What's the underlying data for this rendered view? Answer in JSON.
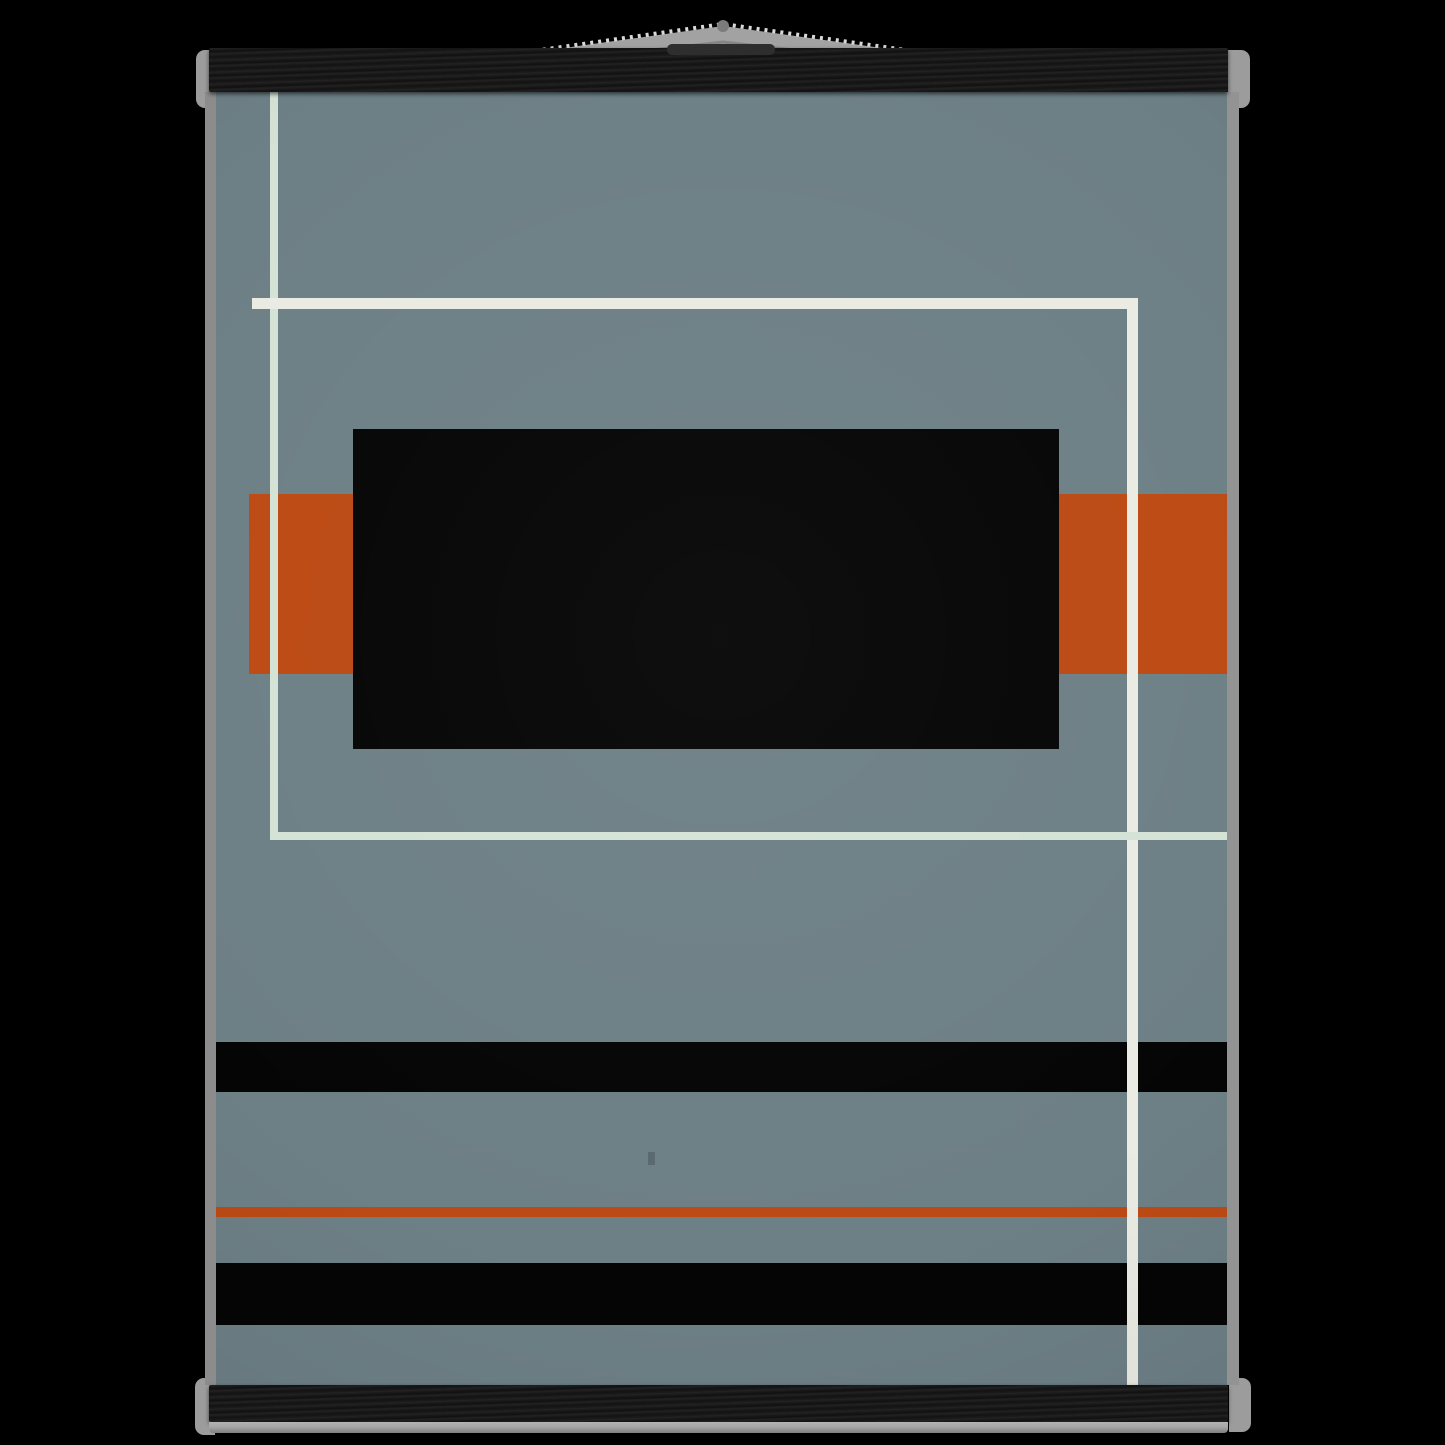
{
  "scene": {
    "type": "poster-mockup-photo",
    "description": "Abstract geometric minimalist art print in slate blue-gray with a large central black rectangle, rust-orange blocks, black horizontal stripes, a thin orange rule and off-white/mint grid lines; the print hangs from black wooden magnetic poster hangers with a gray cord on a black background",
    "background_color": "#000000"
  },
  "colors": {
    "scene-bg": "#000000",
    "poster-bg": "#6d8086",
    "art-black": "#050505",
    "art-orange": "#bc4a14",
    "art-mint": "#d4e3d6",
    "art-cream": "#eaebe2",
    "wood": "#191919",
    "cap": "#9c9c9c",
    "strip-left": "#8c8c8c",
    "strip-right": "#939393",
    "lip": "#a6a6a6",
    "string-fill": "#a2a2a2",
    "string-hi": "#d8d8d8",
    "string-sh": "#858585",
    "nail-dot": "#7b7b7b",
    "slit": "#2e2e2e",
    "speck": "#44525a"
  },
  "hanger": {
    "top_bar": {
      "x": 209,
      "y": 48,
      "w": 1019,
      "h": 44
    },
    "bottom_bar": {
      "x": 209,
      "y": 1385,
      "w": 1019,
      "h": 37
    },
    "bottom_lip": {
      "x": 209,
      "y": 1422,
      "w": 1019,
      "h": 11
    },
    "caps": [
      {
        "name": "hanger-cap-top-left",
        "side": "left",
        "x": 196,
        "y": 50,
        "w": 20,
        "h": 58
      },
      {
        "name": "hanger-cap-top-right",
        "side": "right",
        "x": 1228,
        "y": 50,
        "w": 22,
        "h": 58
      },
      {
        "name": "hanger-cap-bottom-left",
        "side": "left",
        "x": 195,
        "y": 1378,
        "w": 20,
        "h": 57
      },
      {
        "name": "hanger-cap-bottom-right",
        "side": "right",
        "x": 1229,
        "y": 1378,
        "w": 22,
        "h": 54
      }
    ],
    "string": {
      "apex": [
        723,
        26
      ],
      "left_end": [
        218,
        96
      ],
      "right_end": [
        1228,
        96
      ],
      "nail_dot": {
        "cx": 723,
        "cy": 26,
        "r": 6
      },
      "slit": {
        "x": 667,
        "y": 44,
        "w": 108,
        "h": 11
      }
    }
  },
  "poster": {
    "x": 216,
    "y": 92,
    "w": 1011,
    "h": 1293,
    "left_edge_strip": {
      "x": 205,
      "y": 92,
      "w": 11,
      "h": 1293
    },
    "right_edge_strip": {
      "x": 1227,
      "y": 92,
      "w": 12,
      "h": 1293
    }
  },
  "artwork": {
    "elements": [
      {
        "name": "orange-block-left",
        "x": 249,
        "y": 494,
        "w": 104,
        "h": 180,
        "color": "art-orange"
      },
      {
        "name": "orange-block-right",
        "x": 1059,
        "y": 494,
        "w": 168,
        "h": 180,
        "color": "art-orange"
      },
      {
        "name": "center-black-rectangle",
        "x": 353,
        "y": 429,
        "w": 706,
        "h": 320,
        "color": "art-black"
      },
      {
        "name": "black-stripe-upper",
        "x": 216,
        "y": 1042,
        "w": 1011,
        "h": 50,
        "color": "art-black"
      },
      {
        "name": "orange-rule-line",
        "x": 216,
        "y": 1207,
        "w": 1011,
        "h": 10,
        "color": "art-orange"
      },
      {
        "name": "black-stripe-lower",
        "x": 216,
        "y": 1263,
        "w": 1011,
        "h": 62,
        "color": "art-black"
      },
      {
        "name": "cream-vertical-line",
        "x": 1127,
        "y": 298,
        "w": 11,
        "h": 1087,
        "color": "art-cream"
      },
      {
        "name": "mint-vertical-line",
        "x": 270,
        "y": 92,
        "w": 8,
        "h": 747,
        "color": "art-mint"
      },
      {
        "name": "mint-horizontal-line",
        "x": 270,
        "y": 832,
        "w": 957,
        "h": 8,
        "color": "art-mint"
      },
      {
        "name": "cream-horizontal-line",
        "x": 252,
        "y": 298,
        "w": 886,
        "h": 11,
        "color": "art-cream"
      },
      {
        "name": "paper-speck",
        "x": 648,
        "y": 1152,
        "w": 7,
        "h": 13,
        "color": "speck",
        "opacity": 0.5
      }
    ]
  }
}
